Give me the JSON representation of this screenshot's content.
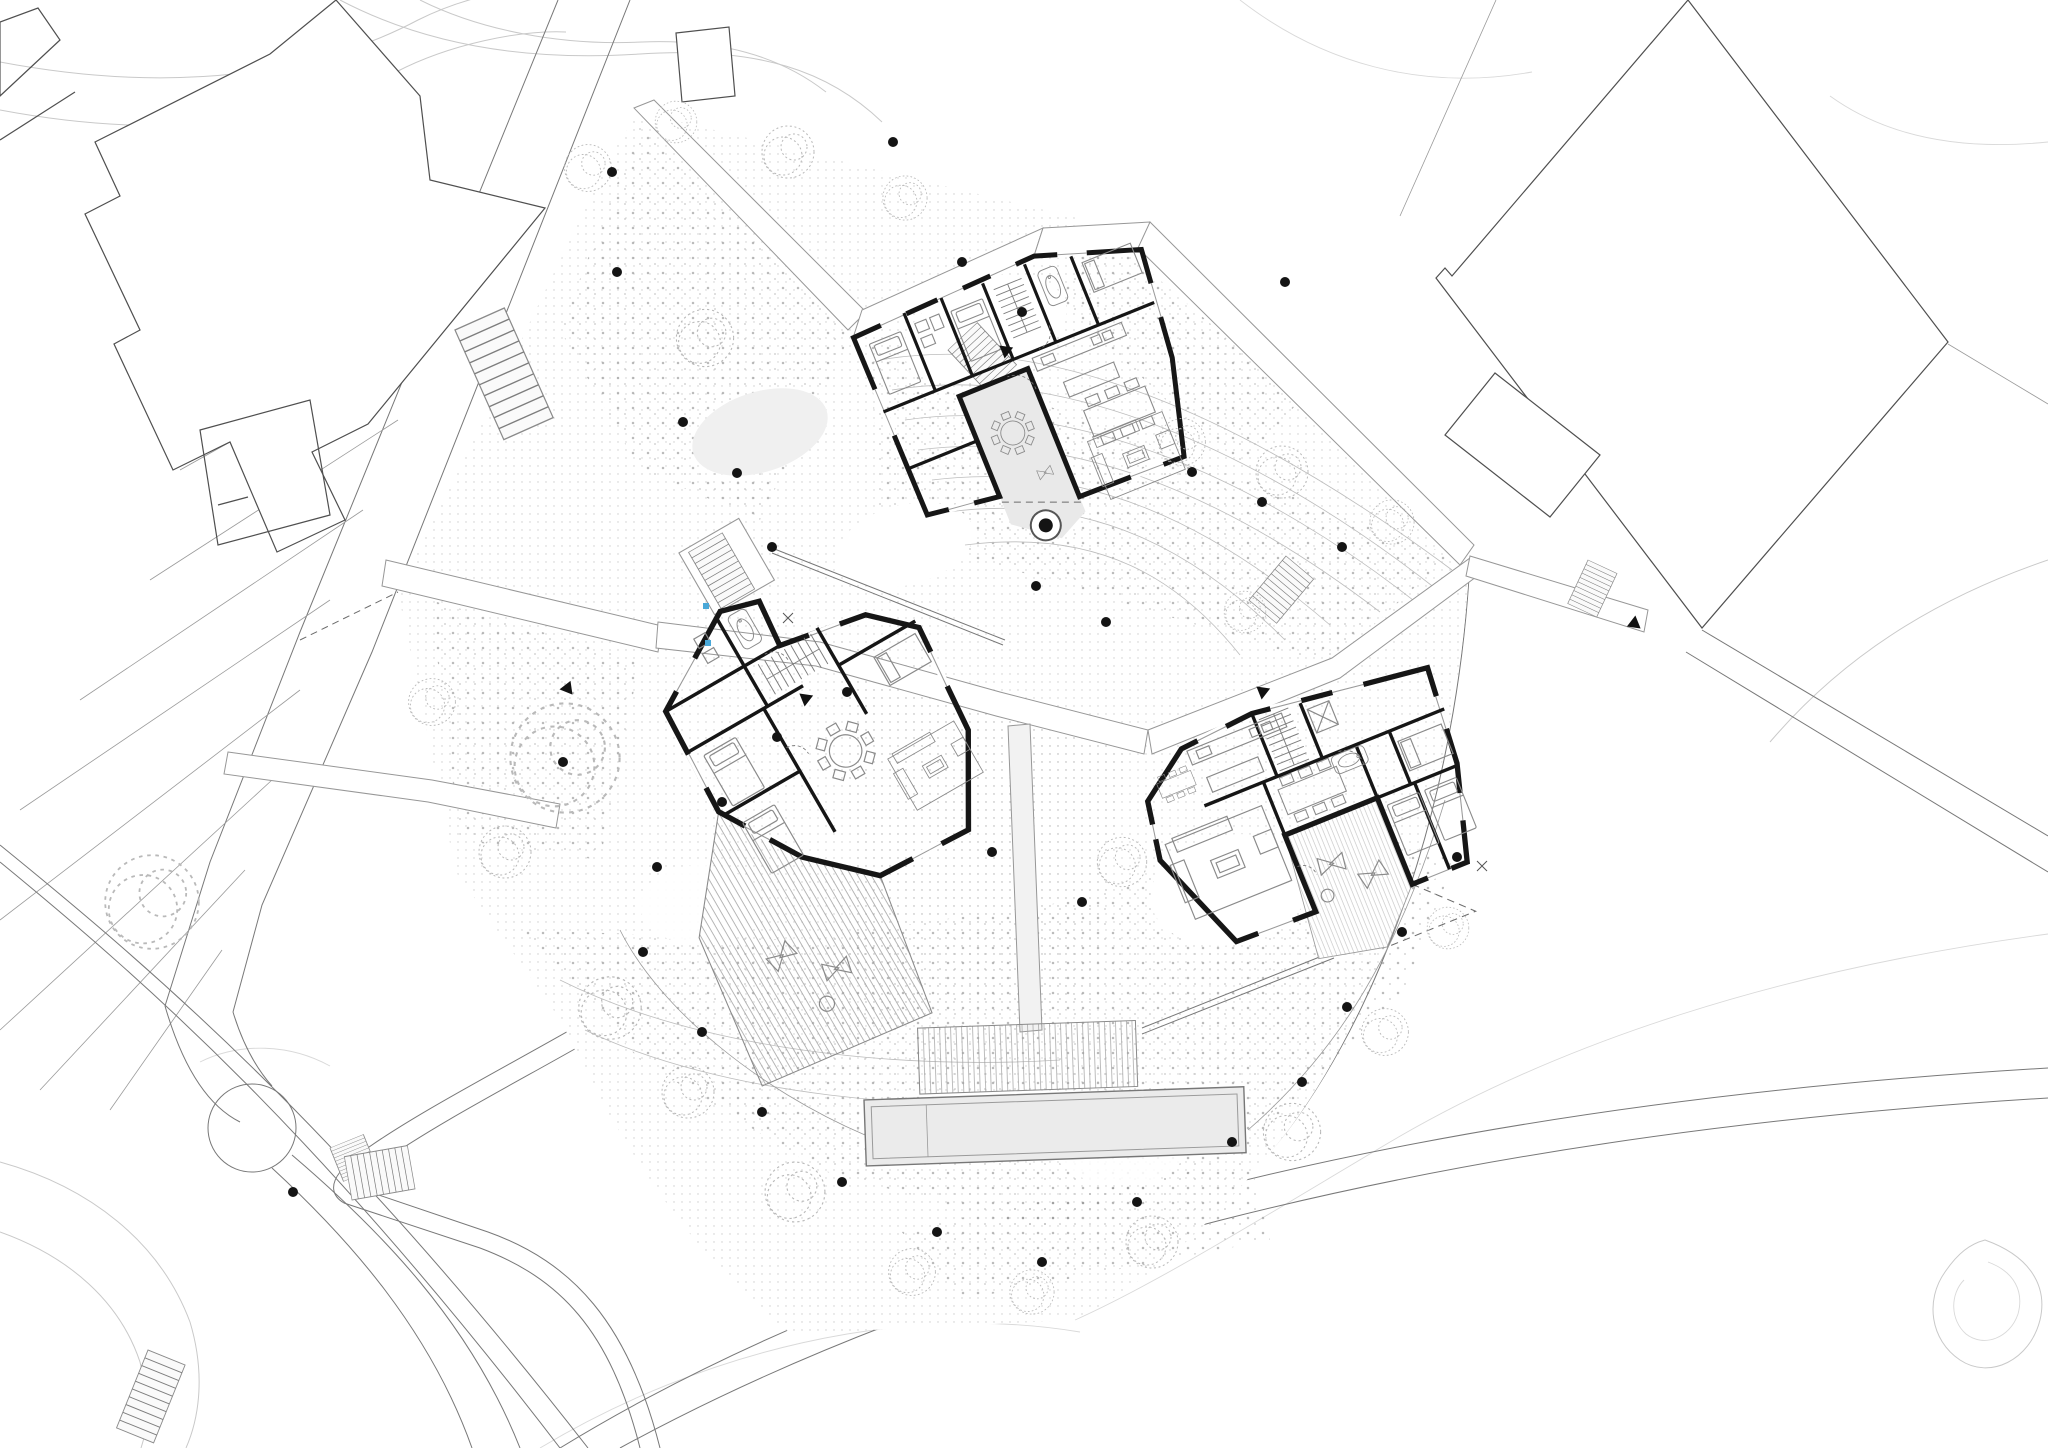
{
  "document": {
    "kind": "architectural site plan",
    "storey": "ground floor with landscape design",
    "visible_text": []
  },
  "colors": {
    "background": "#ffffff",
    "wall": "#161616",
    "building_fill": "#d2d2d2",
    "courtyard_fill": "#e9e9e9",
    "terrace_fill": "#f6f6f6",
    "pool_fill": "#ebebeb",
    "deck_fill": "#f1f1f1",
    "furniture": "#8a8a8a",
    "contour": "#c9c9c9",
    "context_line": "#4f4f4f",
    "road_line": "#787878",
    "path_edge": "#979797",
    "stipple": "#9a9a9a",
    "tree_stroke": "#b9b9b9",
    "shrub_dot": "#141414",
    "accent_blue": "#49a8d8"
  },
  "site": {
    "buildings": [
      {
        "id": "house-north",
        "rooms": [
          "bedroom",
          "bathroom",
          "bedroom",
          "stair-core",
          "bathtub-bathroom",
          "bedroom",
          "kitchen",
          "dining",
          "living"
        ],
        "outdoor": "courtyard-with-round-table-and-tree"
      },
      {
        "id": "house-west",
        "rooms": [
          "entry-bathroom",
          "interior-stair",
          "bedroom",
          "bedroom",
          "round-dining",
          "bedroom",
          "living"
        ],
        "outdoor": "hatched-terrace-with-lounge-chairs"
      },
      {
        "id": "house-east",
        "rooms": [
          "living",
          "kitchen",
          "dining",
          "stair-core-with-lift",
          "bathtub-bathroom",
          "bedroom",
          "bedroom",
          "bedroom"
        ],
        "outdoor": "terrace-with-dashed-extension"
      }
    ],
    "water": {
      "lap_pool": true,
      "pool_deck_hatched": true
    },
    "landscape": {
      "sketch_tree_count": 23,
      "shrub_dot_count": 34,
      "blue_drain_markers": 2,
      "entrance_arrows": 5,
      "outdoor_stair_flights": 8,
      "tree_in_circle": true
    },
    "context": {
      "neighbor_buildings": 6,
      "parking_terrace_rows": 8,
      "roundabout_circle": true,
      "contour_lines": true
    }
  }
}
